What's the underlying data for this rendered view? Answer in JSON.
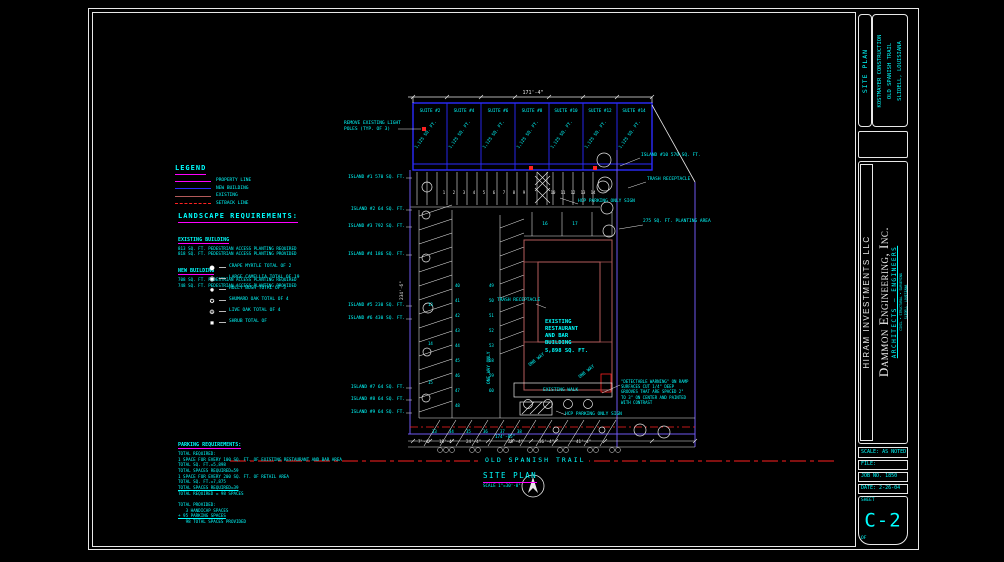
{
  "palette": {
    "c": "#00FFFF",
    "w": "#E8E8E8",
    "m": "#FF00FF",
    "r": "#FF2121",
    "b": "#2B2BFF",
    "p": "#6E58F0",
    "dr": "#B35B5B"
  },
  "legend": {
    "title": "LEGEND",
    "items": [
      {
        "label": "PROPERTY LINE",
        "color": "#FF00FF",
        "style": "solid"
      },
      {
        "label": "NEW BUILDING",
        "color": "#2B2BFF",
        "style": "solid"
      },
      {
        "label": "EXISTING",
        "color": "#B35B5B",
        "style": "solid"
      },
      {
        "label": "SETBACK LINE",
        "color": "#FF2121",
        "style": "dashdot"
      }
    ]
  },
  "landscape": {
    "title": "LANDSCAPE REQUIREMENTS:",
    "sections": [
      {
        "heading": "EXISTING BUILDING",
        "lines": [
          "813 SQ. FT. PEDESTRIAN ACCESS PLANTING REQUIRED",
          "818 SQ. FT. PEDESTRIAN ACCESS PLANTING PROVIDED"
        ]
      },
      {
        "heading": "NEW BUILDING",
        "lines": [
          "708 SQ. FT. PEDESTRIAN ACCESS PLANTING REQUIRED",
          "748 SQ. FT. PEDESTRIAN ACCESS PLANTING PROVIDED"
        ]
      }
    ],
    "plants": [
      {
        "sym": "●",
        "label": "CRAPE MYRTLE TOTAL OF 2"
      },
      {
        "sym": "◉",
        "label": "LARGE CAMELLIA TOTAL OF 19"
      },
      {
        "sym": "✹",
        "label": "HOLLY BUSH TOTAL OF 3"
      },
      {
        "sym": "✪",
        "label": "SHUMARD OAK TOTAL OF 4"
      },
      {
        "sym": "❂",
        "label": "LIVE OAK TOTAL OF 4"
      },
      {
        "sym": "▪",
        "label": "SHRUB TOTAL OF"
      }
    ]
  },
  "parking": {
    "heading": "PARKING REQUIREMENTS:",
    "lines": [
      {
        "t": "TOTAL REQUIRED:"
      },
      {
        "t": "1 SPACE FOR EVERY 100 SQ. FT. OF EXISTING RESTAURANT AND BAR AREA"
      },
      {
        "t": "TOTAL SQ. FT.=5,898"
      },
      {
        "t": "TOTAL SPACES REQUIRED=59"
      },
      {
        "t": "1 SPACE FOR EVERY 200 SQ. FT. OF RETAIL AREA"
      },
      {
        "t": "TOTAL SQ. FT.=7,875"
      },
      {
        "t": "TOTAL SPACES REQUIRED=39",
        "u": 1
      },
      {
        "t": "TOTAL REQUIRED = 98 SPACES"
      },
      {
        "t": " "
      },
      {
        "t": "TOTAL PROVIDED:"
      },
      {
        "t": "   3 HANDICAP SPACES"
      },
      {
        "t": "+ 95 PARKING SPACES",
        "u": 1
      },
      {
        "t": "   98 TOTAL SPACES PROVIDED"
      }
    ]
  },
  "site": {
    "suites": [
      {
        "no": "SUITE #2",
        "sf": "1,125 SQ. FT.",
        "x": 413
      },
      {
        "no": "SUITE #4",
        "sf": "1,125 SQ. FT.",
        "x": 447
      },
      {
        "no": "SUITE #6",
        "sf": "1,125 SQ. FT.",
        "x": 481
      },
      {
        "no": "SUITE #8",
        "sf": "1,125 SQ. FT.",
        "x": 515
      },
      {
        "no": "SUITE #10",
        "sf": "1,125 SQ. FT.",
        "x": 549
      },
      {
        "no": "SUITE #12",
        "sf": "1,125 SQ. FT.",
        "x": 583
      },
      {
        "no": "SUITE #14",
        "sf": "1,125 SQ. FT.",
        "x": 617
      }
    ],
    "labels": [
      {
        "t": "REMOVE EXISTING LIGHT\nPOLES (TYP. OF 3)",
        "x": 344,
        "y": 121,
        "s": 4.5
      },
      {
        "t": "171'-4\"",
        "x": 533,
        "y": 90,
        "c": "w",
        "s": 5,
        "a": "c"
      },
      {
        "t": "ISLAND #1 570 SQ. FT.",
        "x": 405,
        "y": 175,
        "a": "r"
      },
      {
        "t": "ISLAND #2 64 SQ. FT.",
        "x": 405,
        "y": 207,
        "a": "r"
      },
      {
        "t": "ISLAND #3 792 SQ. FT.",
        "x": 405,
        "y": 224,
        "a": "r"
      },
      {
        "t": "ISLAND #4 186 SQ. FT.",
        "x": 405,
        "y": 252,
        "a": "r"
      },
      {
        "t": "ISLAND #5 230 SQ. FT.",
        "x": 405,
        "y": 303,
        "a": "r"
      },
      {
        "t": "ISLAND #6 430 SQ. FT.",
        "x": 405,
        "y": 316,
        "a": "r"
      },
      {
        "t": "ISLAND #7 64 SQ. FT.",
        "x": 405,
        "y": 385,
        "a": "r"
      },
      {
        "t": "ISLAND #8 64 SQ. FT.",
        "x": 405,
        "y": 397,
        "a": "r"
      },
      {
        "t": "ISLAND #9 64 SQ. FT.",
        "x": 405,
        "y": 410,
        "a": "r"
      },
      {
        "t": "ISLAND #10 570 SQ. FT.",
        "x": 641,
        "y": 153
      },
      {
        "t": "TRASH RECEPTACLE",
        "x": 647,
        "y": 177
      },
      {
        "t": "HCP PARKING ONLY SIGN",
        "x": 578,
        "y": 199
      },
      {
        "t": "275 SQ. FT. PLANTING AREA",
        "x": 643,
        "y": 219
      },
      {
        "t": "TRASH RECEPTACLE",
        "x": 497,
        "y": 298
      },
      {
        "t": "EXISTING\nRESTAURANT\nAND BAR\nBUILDING\n5,898 SQ. FT.",
        "x": 545,
        "y": 319,
        "s": 5.5,
        "b": 1
      },
      {
        "t": "EXISTING WALK",
        "x": 543,
        "y": 388
      },
      {
        "t": "HCP PARKING ONLY SIGN",
        "x": 565,
        "y": 412
      },
      {
        "t": "\"DETECTABLE WARNING\" ON RAMP\nSURFACES CUT 1/4\" DEEP\nGROOVES THAT ARE SPACED 2\"\nTO 3\" ON CENTER AND PAINTED\nWITH CONTRAST",
        "x": 621,
        "y": 379,
        "s": 4
      },
      {
        "t": "234'-6\"",
        "x": 400,
        "y": 300,
        "c": "w",
        "s": 4.5,
        "r": -90
      },
      {
        "t": "ONE WAY ONLY",
        "x": 487,
        "y": 384,
        "s": 4.5,
        "r": -90
      },
      {
        "t": "ONE WAY",
        "x": 528,
        "y": 364,
        "s": 4.5,
        "r": -38
      },
      {
        "t": "ONE WAY",
        "x": 578,
        "y": 376,
        "s": 4.5,
        "r": -38
      },
      {
        "t": "OLD SPANISH TRAIL",
        "x": 482,
        "y": 456,
        "s": 6.5,
        "ls": 2,
        "bg": 1
      },
      {
        "t": "SITE PLAN",
        "x": 483,
        "y": 471,
        "s": 7.5,
        "ls": 1.5,
        "u": "m"
      },
      {
        "t": "SCALE 1\"=30'-0\"",
        "x": 483,
        "y": 483,
        "s": 4.2
      },
      {
        "t": "174'-05\"",
        "x": 495,
        "y": 434,
        "s": 4.2
      },
      {
        "t": "7'-4\"",
        "x": 418,
        "y": 439,
        "c": "w",
        "s": 4.2
      },
      {
        "t": "18'-4\"",
        "x": 439,
        "y": 439,
        "c": "w",
        "s": 4.2
      },
      {
        "t": "24'-4\"",
        "x": 466,
        "y": 439,
        "c": "w",
        "s": 4.2
      },
      {
        "t": "25'-4\"",
        "x": 508,
        "y": 439,
        "c": "w",
        "s": 4.2
      },
      {
        "t": "36'-4\"",
        "x": 539,
        "y": 439,
        "c": "w",
        "s": 4.2
      },
      {
        "t": "41'-4\"",
        "x": 576,
        "y": 439,
        "c": "w",
        "s": 4.2
      },
      {
        "t": "1",
        "x": 444,
        "y": 190,
        "c": "w",
        "s": 4,
        "a": "c"
      },
      {
        "t": "2",
        "x": 454,
        "y": 190,
        "c": "w",
        "s": 4,
        "a": "c"
      },
      {
        "t": "3",
        "x": 464,
        "y": 190,
        "c": "w",
        "s": 4,
        "a": "c"
      },
      {
        "t": "4",
        "x": 474,
        "y": 190,
        "c": "w",
        "s": 4,
        "a": "c"
      },
      {
        "t": "5",
        "x": 484,
        "y": 190,
        "c": "w",
        "s": 4,
        "a": "c"
      },
      {
        "t": "6",
        "x": 494,
        "y": 190,
        "c": "w",
        "s": 4,
        "a": "c"
      },
      {
        "t": "7",
        "x": 504,
        "y": 190,
        "c": "w",
        "s": 4,
        "a": "c"
      },
      {
        "t": "8",
        "x": 514,
        "y": 190,
        "c": "w",
        "s": 4,
        "a": "c"
      },
      {
        "t": "9",
        "x": 524,
        "y": 190,
        "c": "w",
        "s": 4,
        "a": "c"
      },
      {
        "t": "10",
        "x": 553,
        "y": 190,
        "c": "w",
        "s": 4,
        "a": "c"
      },
      {
        "t": "11",
        "x": 563,
        "y": 190,
        "c": "w",
        "s": 4,
        "a": "c"
      },
      {
        "t": "12",
        "x": 573,
        "y": 190,
        "c": "w",
        "s": 4,
        "a": "c"
      },
      {
        "t": "13",
        "x": 583,
        "y": 190,
        "c": "w",
        "s": 4,
        "a": "c"
      },
      {
        "t": "14",
        "x": 593,
        "y": 190,
        "c": "w",
        "s": 4,
        "a": "c"
      },
      {
        "t": "16",
        "x": 545,
        "y": 222,
        "c": "c",
        "s": 4.5,
        "a": "c"
      },
      {
        "t": "17",
        "x": 575,
        "y": 222,
        "c": "c",
        "s": 4.5,
        "a": "c"
      },
      {
        "t": "13",
        "x": 428,
        "y": 302,
        "c": "c",
        "s": 4
      },
      {
        "t": "14",
        "x": 428,
        "y": 341,
        "c": "c",
        "s": 4
      },
      {
        "t": "15",
        "x": 428,
        "y": 380,
        "c": "c",
        "s": 4
      },
      {
        "t": "40",
        "x": 455,
        "y": 283,
        "c": "c",
        "s": 4
      },
      {
        "t": "41",
        "x": 455,
        "y": 298,
        "c": "c",
        "s": 4
      },
      {
        "t": "42",
        "x": 455,
        "y": 313,
        "c": "c",
        "s": 4
      },
      {
        "t": "43",
        "x": 455,
        "y": 328,
        "c": "c",
        "s": 4
      },
      {
        "t": "44",
        "x": 455,
        "y": 343,
        "c": "c",
        "s": 4
      },
      {
        "t": "45",
        "x": 455,
        "y": 358,
        "c": "c",
        "s": 4
      },
      {
        "t": "46",
        "x": 455,
        "y": 373,
        "c": "c",
        "s": 4
      },
      {
        "t": "47",
        "x": 455,
        "y": 388,
        "c": "c",
        "s": 4
      },
      {
        "t": "48",
        "x": 455,
        "y": 403,
        "c": "c",
        "s": 4
      },
      {
        "t": "49",
        "x": 489,
        "y": 283,
        "c": "c",
        "s": 4
      },
      {
        "t": "50",
        "x": 489,
        "y": 298,
        "c": "c",
        "s": 4
      },
      {
        "t": "51",
        "x": 489,
        "y": 313,
        "c": "c",
        "s": 4
      },
      {
        "t": "52",
        "x": 489,
        "y": 328,
        "c": "c",
        "s": 4
      },
      {
        "t": "53",
        "x": 489,
        "y": 343,
        "c": "c",
        "s": 4
      },
      {
        "t": "58",
        "x": 489,
        "y": 358,
        "c": "c",
        "s": 4
      },
      {
        "t": "59",
        "x": 489,
        "y": 373,
        "c": "c",
        "s": 4
      },
      {
        "t": "60",
        "x": 489,
        "y": 388,
        "c": "c",
        "s": 4
      },
      {
        "t": "33",
        "x": 432,
        "y": 429,
        "c": "c",
        "s": 4
      },
      {
        "t": "34",
        "x": 449,
        "y": 429,
        "c": "c",
        "s": 4
      },
      {
        "t": "35",
        "x": 466,
        "y": 429,
        "c": "c",
        "s": 4
      },
      {
        "t": "36",
        "x": 483,
        "y": 429,
        "c": "c",
        "s": 4
      },
      {
        "t": "37",
        "x": 500,
        "y": 429,
        "c": "c",
        "s": 4
      },
      {
        "t": "38",
        "x": 517,
        "y": 429,
        "c": "c",
        "s": 4
      }
    ]
  },
  "titleblock": {
    "sheet_title": "SITE PLAN",
    "client_lines": [
      "KOSTMAYER CONSTRUCTION",
      "OLD SPANISH TRAIL",
      "SLIDELL, LOUISIANA"
    ],
    "owner": "HIRAM INVESTMENTS LLC",
    "firm": "Dammon Engineering, Inc.",
    "firm_sub": "ARCHITECTS — ENGINEERS",
    "addr1": "CIVIL • STRUCTURAL • SURVEYING",
    "addr2": "SLIDELL, LOUISIANA",
    "scale": "SCALE: AS NOTED",
    "file": "FILE:",
    "job": "JOB NO. 1850",
    "date": "DATE: 2-26-04",
    "sheet_label": "SHEET",
    "sheet_no": "C-2",
    "of_label": "OF"
  }
}
